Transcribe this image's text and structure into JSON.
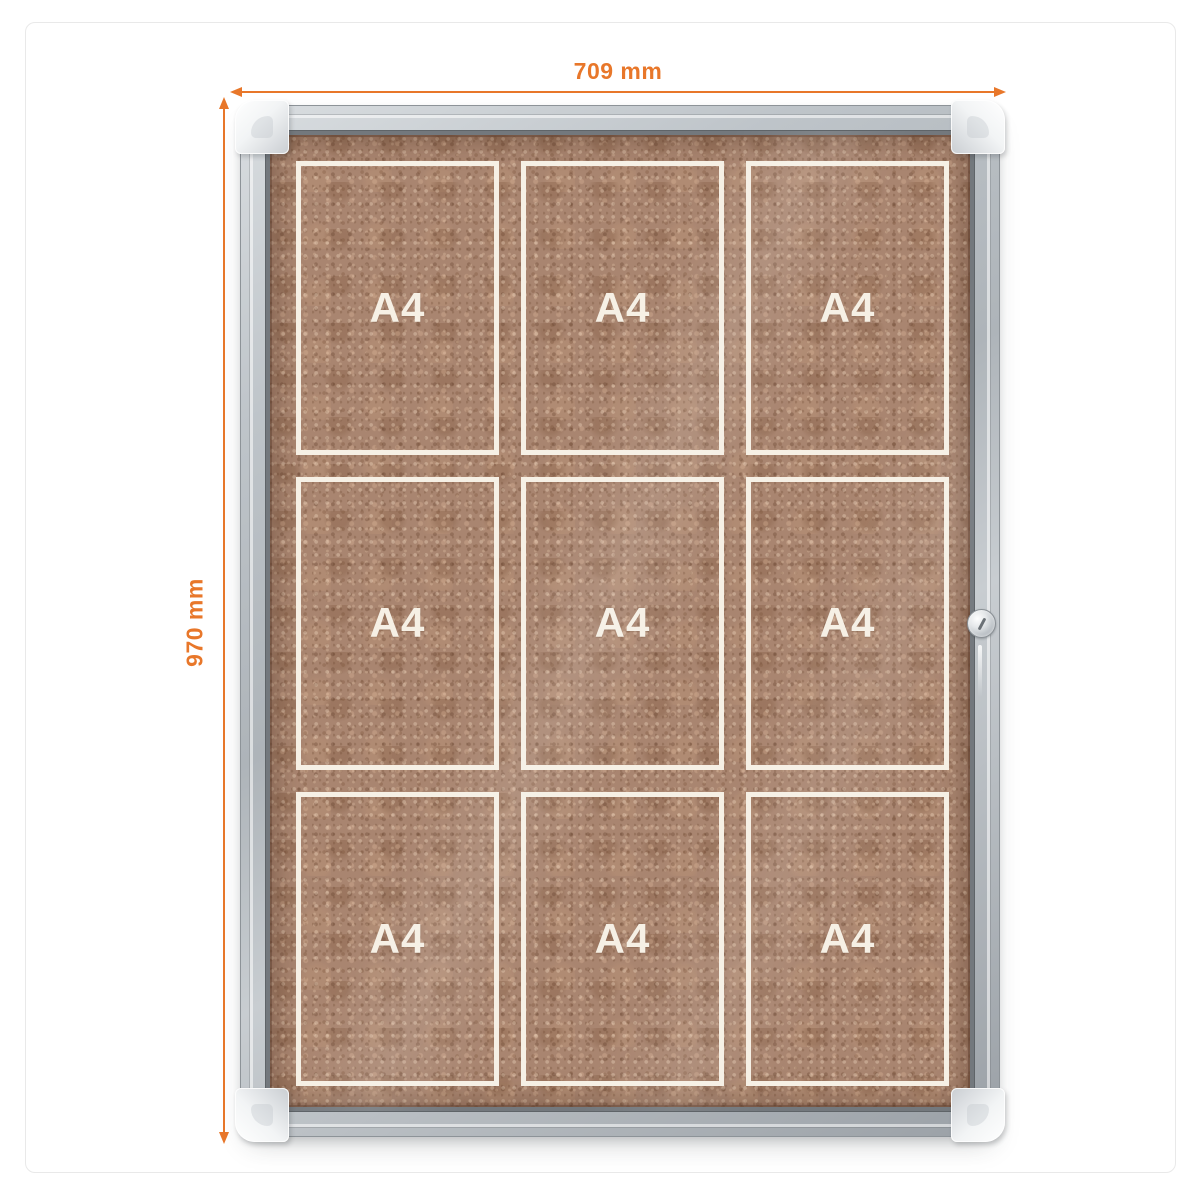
{
  "product": {
    "name": "lockable-cork-notice-board",
    "grid": {
      "rows": 3,
      "columns": 3
    }
  },
  "dimensions": {
    "width_label": "709 mm",
    "height_label": "970 mm",
    "annotation_color": "#e8772a"
  },
  "board": {
    "cells": [
      {
        "label": "A4"
      },
      {
        "label": "A4"
      },
      {
        "label": "A4"
      },
      {
        "label": "A4"
      },
      {
        "label": "A4"
      },
      {
        "label": "A4"
      },
      {
        "label": "A4"
      },
      {
        "label": "A4"
      },
      {
        "label": "A4"
      }
    ],
    "colors": {
      "cork": "#a98570",
      "frame_silver": "#b7bdc2",
      "grid_line": "#f6f0e5",
      "label_text": "#f6f0e5"
    }
  }
}
